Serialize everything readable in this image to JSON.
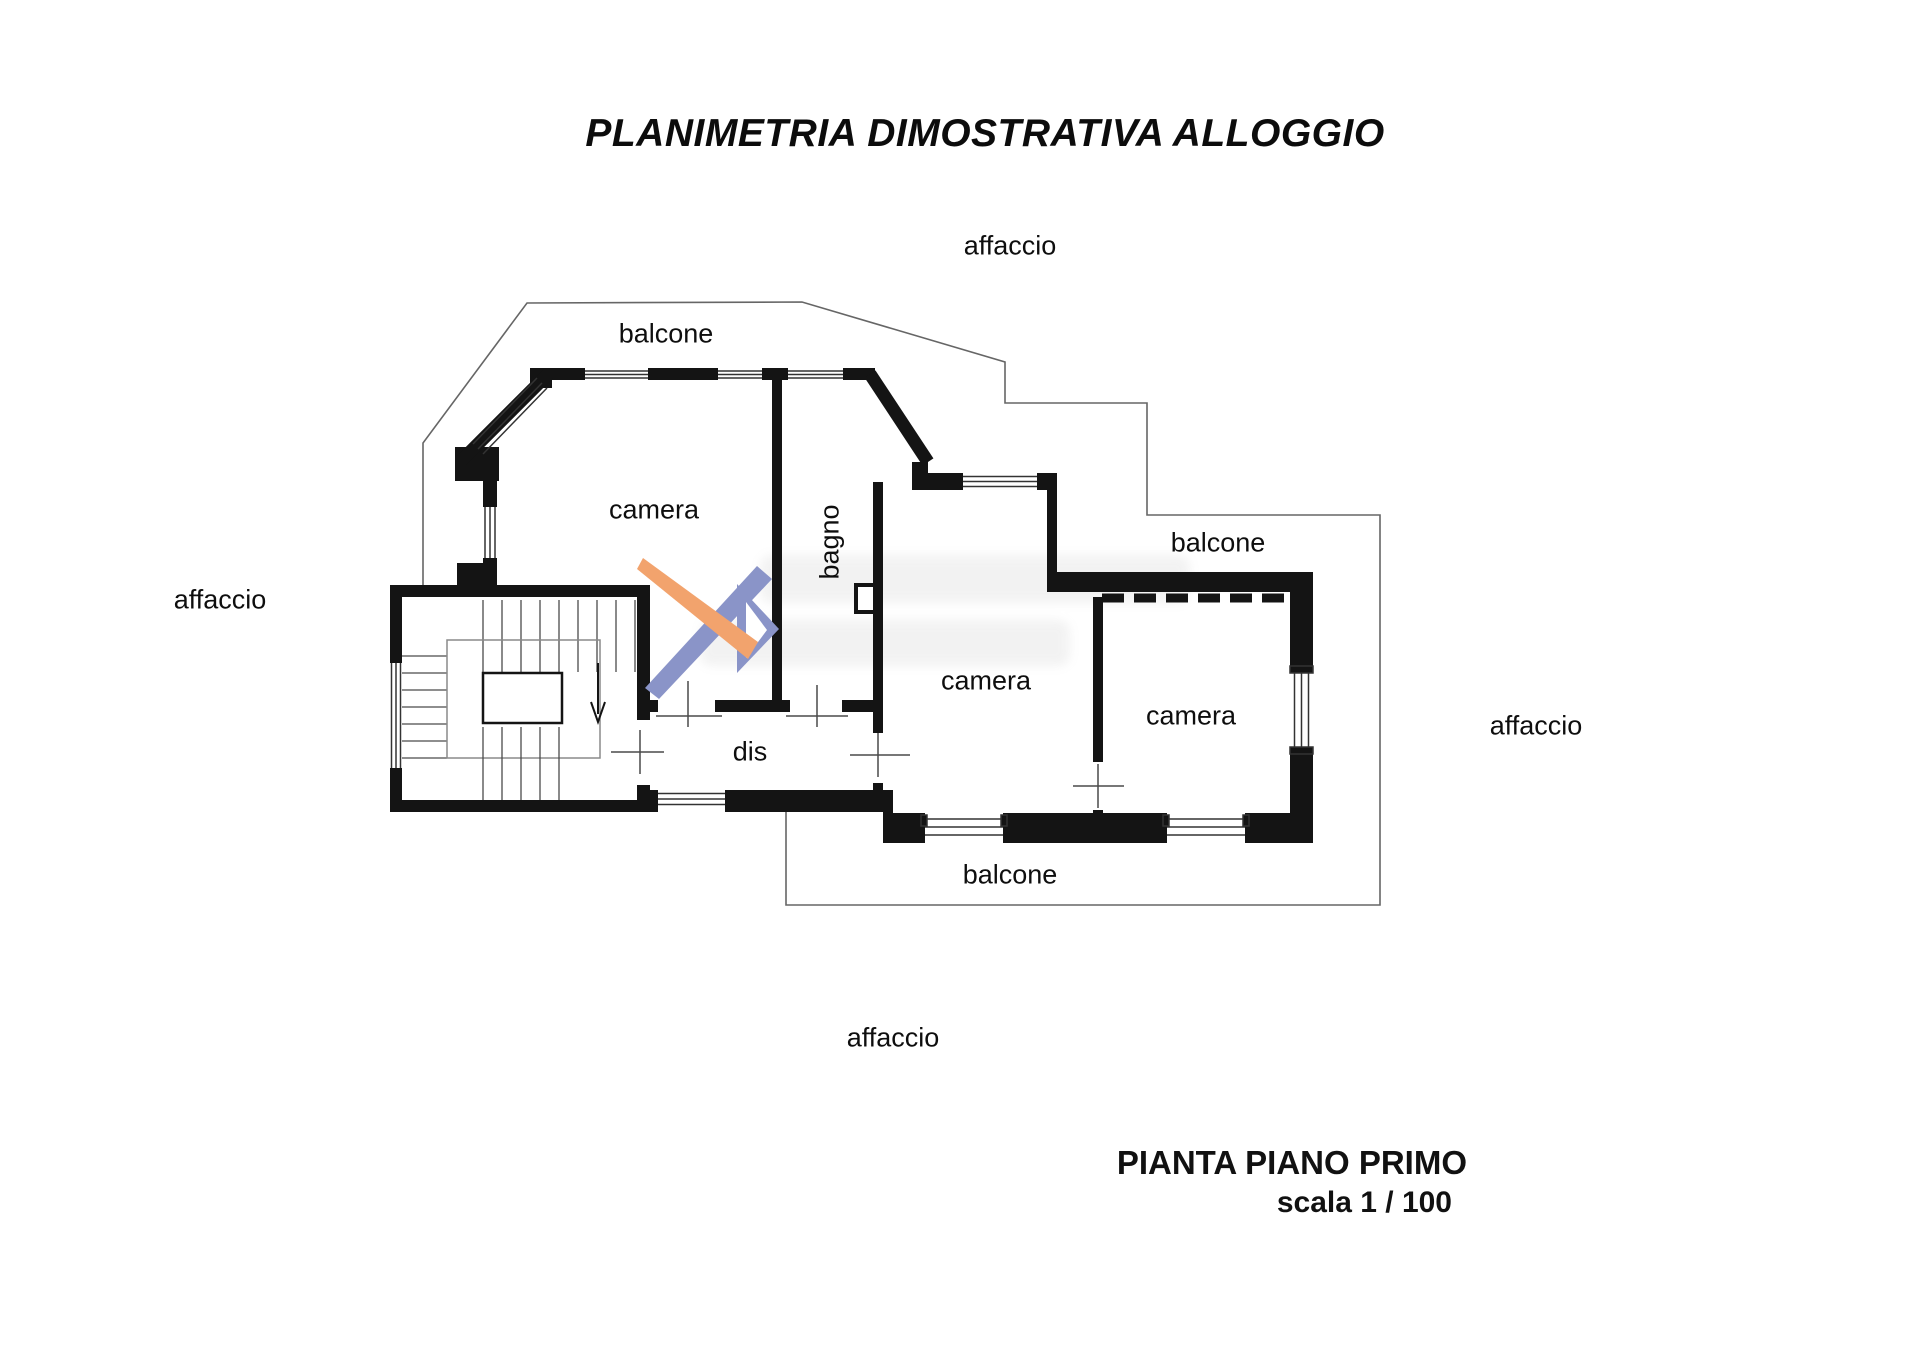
{
  "document": {
    "title": "PLANIMETRIA DIMOSTRATIVA ALLOGGIO",
    "caption": {
      "line1": "PIANTA PIANO PRIMO",
      "line2": "scala 1 / 100"
    }
  },
  "floorplan": {
    "rooms": {
      "camera_nw": "camera",
      "bagno": "bagno",
      "camera_mid": "camera",
      "camera_right": "camera",
      "dis": "dis"
    },
    "balconies": {
      "top": "balcone",
      "right": "balcone",
      "bottom": "balcone"
    },
    "views": {
      "top": "affaccio",
      "left": "affaccio",
      "right": "affaccio",
      "bottom": "affaccio"
    },
    "stairs": {
      "direction_arrow": "down"
    },
    "colors": {
      "walls": "#141414",
      "boundary_line": "#666666",
      "watermark_orange": "#f2a36d",
      "watermark_blue": "#8a94c8"
    }
  }
}
